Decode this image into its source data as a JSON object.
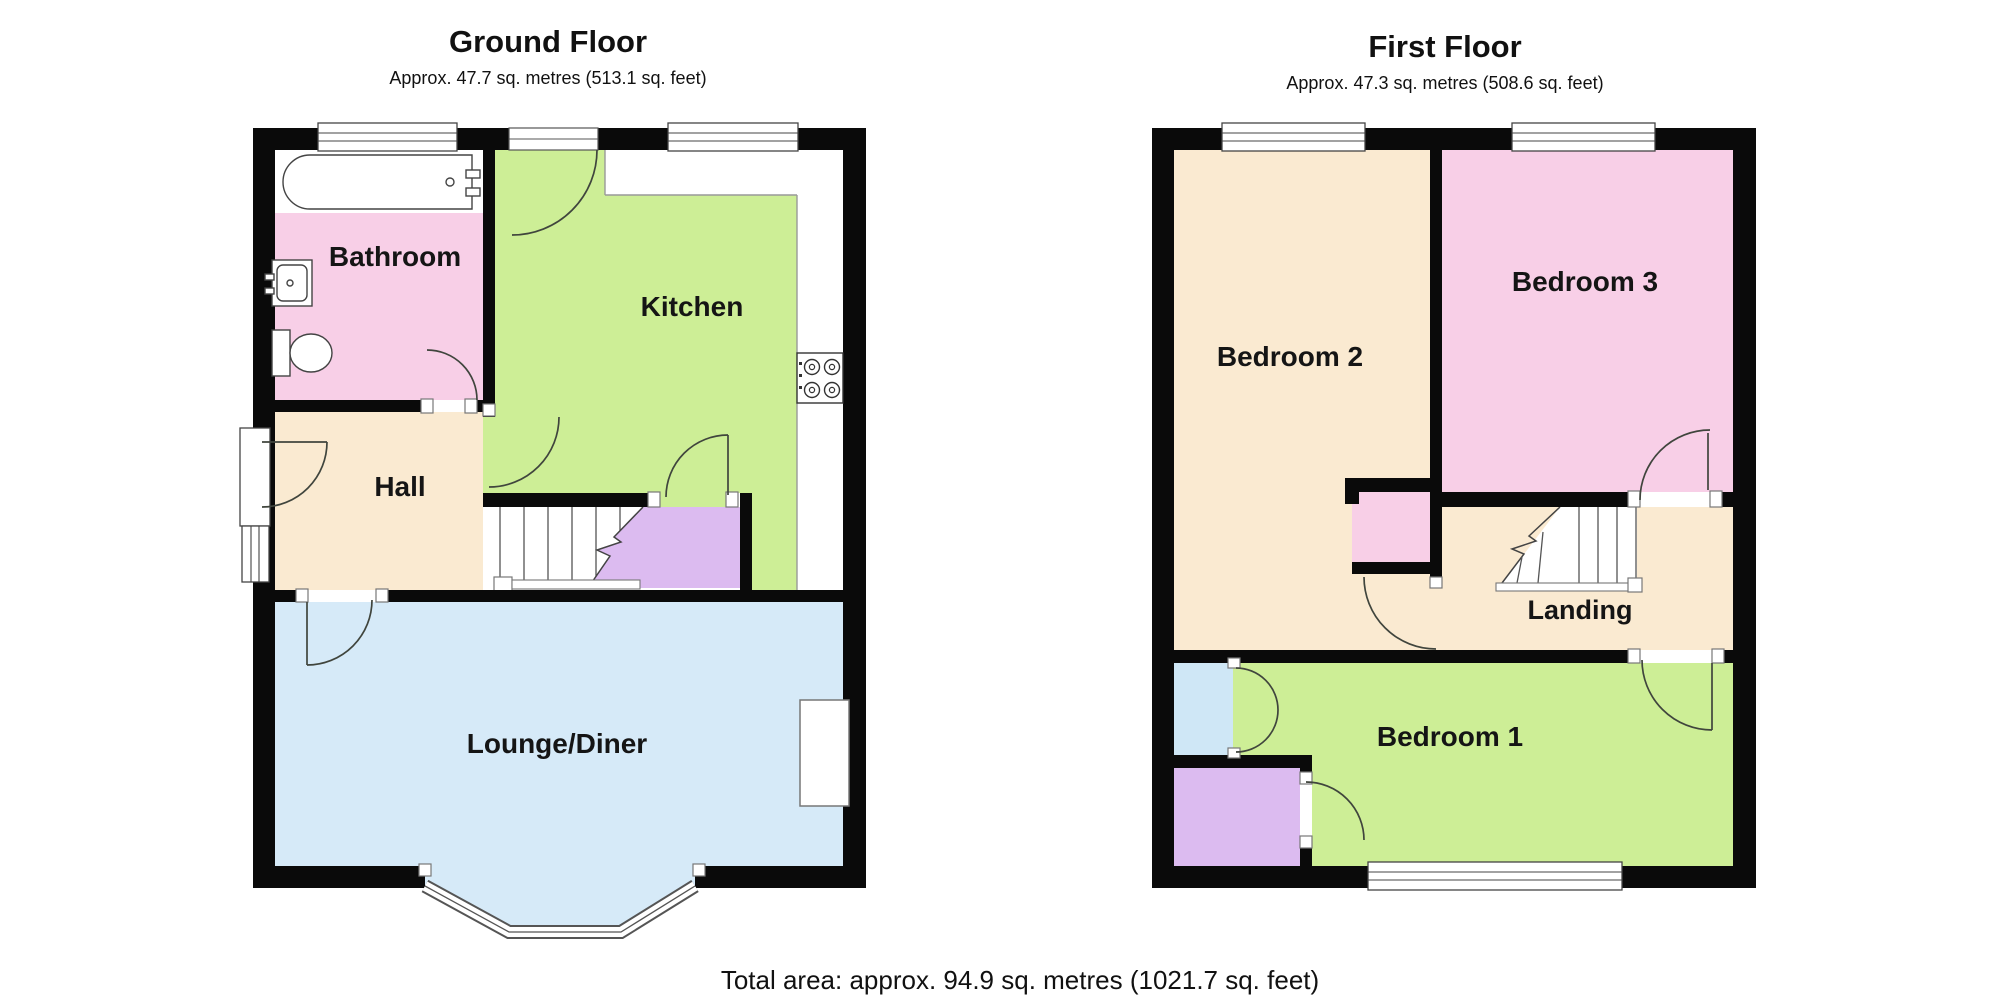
{
  "ground_floor": {
    "title": "Ground Floor",
    "subtitle": "Approx. 47.7 sq. metres (513.1 sq. feet)",
    "rooms": {
      "bathroom": "Bathroom",
      "kitchen": "Kitchen",
      "hall": "Hall",
      "lounge_diner": "Lounge/Diner"
    }
  },
  "first_floor": {
    "title": "First Floor",
    "subtitle": "Approx. 47.3 sq. metres (508.6 sq. feet)",
    "rooms": {
      "bedroom2": "Bedroom 2",
      "bedroom3": "Bedroom 3",
      "landing": "Landing",
      "bedroom1": "Bedroom 1"
    }
  },
  "footer": {
    "total_area": "Total area: approx. 94.9 sq. metres (1021.7 sq. feet)"
  },
  "colors": {
    "wall": "#0a0a0a",
    "pink": "#f8cfe7",
    "green": "#cdee96",
    "cream": "#faead1",
    "blue": "#d6eaf8",
    "purple": "#dcbbf0",
    "light_blue": "#cfe7f6"
  }
}
